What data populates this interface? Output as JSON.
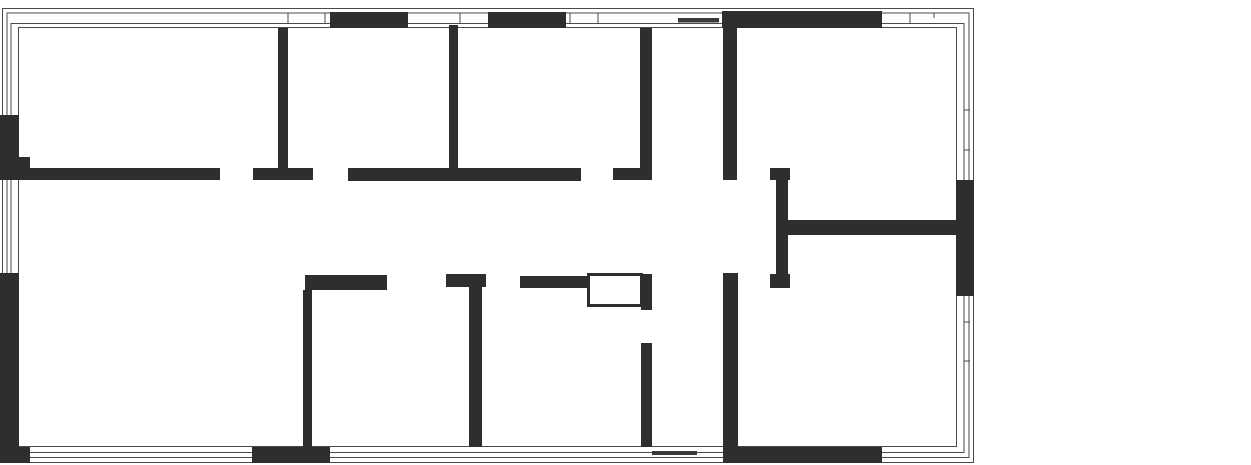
{
  "canvas": {
    "width": 1251,
    "height": 465,
    "background": "#ffffff"
  },
  "floorplan": {
    "type": "architectural-floor-plan",
    "colors": {
      "wall": "#2e2e2e",
      "outline": "#4a4a4a",
      "door_leaf": "#3a3a3a",
      "shaft_fill": "#ffffff",
      "background": "#ffffff"
    },
    "outline_rects": [
      {
        "x": 2.5,
        "y": 8.5,
        "w": 971,
        "h": 454
      },
      {
        "x": 7,
        "y": 13,
        "w": 962,
        "h": 444.5
      },
      {
        "x": 11,
        "y": 23.5,
        "w": 953,
        "h": 429
      },
      {
        "x": 18.5,
        "y": 27.5,
        "w": 938,
        "h": 419
      }
    ],
    "walls": [
      {
        "x": 330,
        "y": 12,
        "w": 78,
        "h": 16,
        "part": "top-exterior"
      },
      {
        "x": 488,
        "y": 12,
        "w": 78,
        "h": 16,
        "part": "top-exterior"
      },
      {
        "x": 722,
        "y": 11,
        "w": 160,
        "h": 17,
        "part": "top-exterior"
      },
      {
        "x": 0,
        "y": 115,
        "w": 19,
        "h": 65,
        "part": "left-exterior"
      },
      {
        "x": 19,
        "y": 157,
        "w": 11,
        "h": 23,
        "part": "left-exterior-step"
      },
      {
        "x": 0,
        "y": 273,
        "w": 19,
        "h": 190,
        "part": "left-exterior"
      },
      {
        "x": 0,
        "y": 447,
        "w": 30,
        "h": 16,
        "part": "bottom-left-corner"
      },
      {
        "x": 956,
        "y": 180,
        "w": 18,
        "h": 116,
        "part": "right-exterior"
      },
      {
        "x": 252,
        "y": 447,
        "w": 78,
        "h": 16,
        "part": "bottom-exterior"
      },
      {
        "x": 723,
        "y": 447,
        "w": 159,
        "h": 16,
        "part": "bottom-exterior"
      },
      {
        "x": 0,
        "y": 168,
        "w": 220,
        "h": 12,
        "part": "corridor-top"
      },
      {
        "x": 253,
        "y": 168,
        "w": 60,
        "h": 12,
        "part": "corridor-top"
      },
      {
        "x": 278,
        "y": 28,
        "w": 10,
        "h": 140,
        "part": "room-divider"
      },
      {
        "x": 348,
        "y": 168,
        "w": 233,
        "h": 13,
        "part": "corridor-top"
      },
      {
        "x": 449,
        "y": 25,
        "w": 9,
        "h": 143,
        "part": "room-divider"
      },
      {
        "x": 640,
        "y": 28,
        "w": 12,
        "h": 140,
        "part": "room-divider"
      },
      {
        "x": 613,
        "y": 168,
        "w": 39,
        "h": 12,
        "part": "corridor-top"
      },
      {
        "x": 723,
        "y": 28,
        "w": 14,
        "h": 152,
        "part": "room-divider"
      },
      {
        "x": 770,
        "y": 168,
        "w": 20,
        "h": 12,
        "part": "t-wall-cap"
      },
      {
        "x": 776,
        "y": 180,
        "w": 12,
        "h": 96,
        "part": "t-wall-stem"
      },
      {
        "x": 770,
        "y": 274,
        "w": 20,
        "h": 14,
        "part": "t-wall-foot"
      },
      {
        "x": 788,
        "y": 220,
        "w": 170,
        "h": 15,
        "part": "right-room-divider"
      },
      {
        "x": 305,
        "y": 275,
        "w": 82,
        "h": 15,
        "part": "corridor-bottom"
      },
      {
        "x": 303,
        "y": 290,
        "w": 9,
        "h": 157,
        "part": "room-divider"
      },
      {
        "x": 446,
        "y": 274,
        "w": 40,
        "h": 13,
        "part": "corridor-bottom"
      },
      {
        "x": 469,
        "y": 287,
        "w": 13,
        "h": 160,
        "part": "room-divider"
      },
      {
        "x": 520,
        "y": 276,
        "w": 67,
        "h": 12,
        "part": "corridor-bottom"
      },
      {
        "x": 641,
        "y": 274,
        "w": 11,
        "h": 36,
        "part": "shaft-side"
      },
      {
        "x": 641,
        "y": 343,
        "w": 11,
        "h": 104,
        "part": "room-divider"
      },
      {
        "x": 723,
        "y": 273,
        "w": 15,
        "h": 190,
        "part": "room-divider"
      }
    ],
    "shaft": {
      "x": 588.5,
      "y": 274.5,
      "w": 53,
      "h": 31,
      "stroke_width": 3
    },
    "window_mullions": [
      {
        "x1": 288,
        "y1": 13,
        "x2": 288,
        "y2": 24,
        "edge": "top"
      },
      {
        "x1": 325,
        "y1": 13,
        "x2": 325,
        "y2": 24,
        "edge": "top"
      },
      {
        "x1": 460,
        "y1": 13,
        "x2": 460,
        "y2": 24,
        "edge": "top"
      },
      {
        "x1": 570,
        "y1": 13,
        "x2": 570,
        "y2": 24,
        "edge": "top"
      },
      {
        "x1": 598,
        "y1": 13,
        "x2": 598,
        "y2": 24,
        "edge": "top"
      },
      {
        "x1": 910,
        "y1": 13,
        "x2": 910,
        "y2": 24,
        "edge": "top"
      },
      {
        "x1": 934,
        "y1": 13,
        "x2": 934,
        "y2": 18,
        "edge": "top"
      },
      {
        "x1": 963.5,
        "y1": 110,
        "x2": 970,
        "y2": 110,
        "edge": "right"
      },
      {
        "x1": 963.5,
        "y1": 150,
        "x2": 970,
        "y2": 150,
        "edge": "right"
      },
      {
        "x1": 963.5,
        "y1": 322,
        "x2": 970,
        "y2": 322,
        "edge": "right"
      },
      {
        "x1": 963.5,
        "y1": 361,
        "x2": 970,
        "y2": 361,
        "edge": "right"
      }
    ],
    "door_leaves": [
      {
        "x": 678,
        "y": 18,
        "w": 41,
        "h": 4.5,
        "edge": "top"
      },
      {
        "x": 652,
        "y": 451,
        "w": 45,
        "h": 4,
        "edge": "bottom"
      }
    ]
  }
}
